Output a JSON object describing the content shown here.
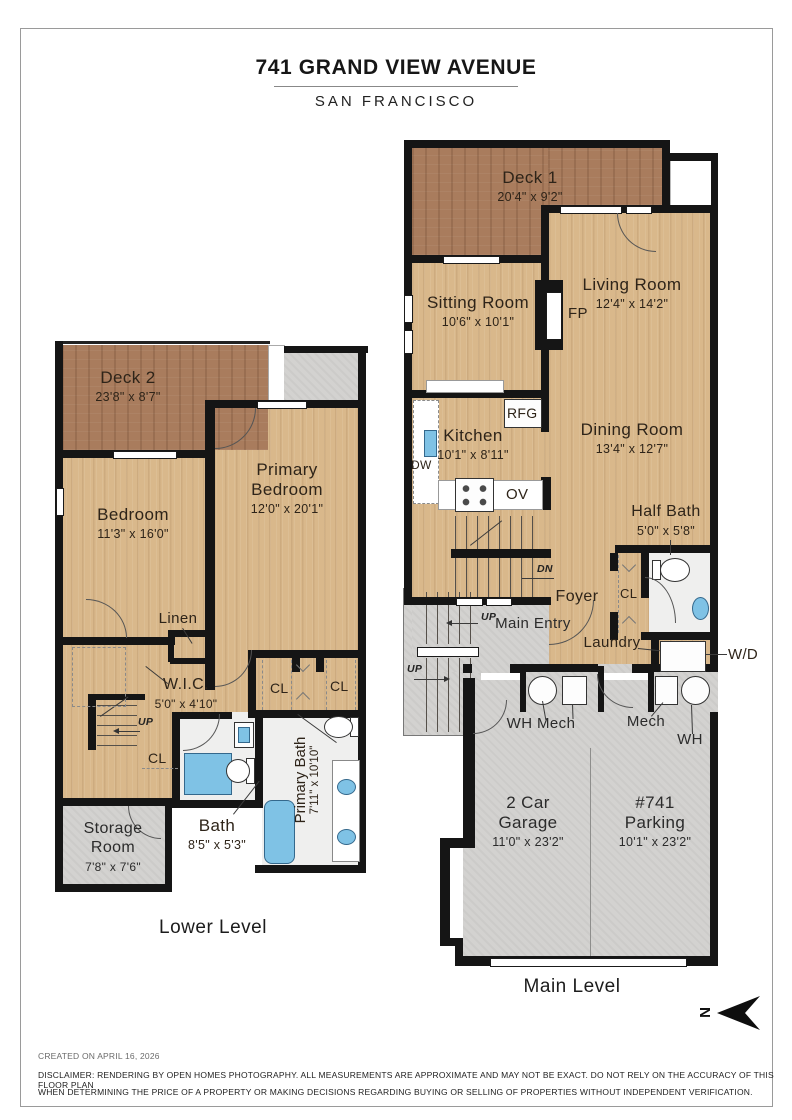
{
  "page": {
    "title": "741 GRAND VIEW AVENUE",
    "subtitle": "SAN FRANCISCO"
  },
  "main": {
    "label": "Main Level",
    "deck1": {
      "name": "Deck 1",
      "dims": "20'4\" x 9'2\""
    },
    "sitting": {
      "name": "Sitting Room",
      "dims": "10'6\" x 10'1\""
    },
    "living": {
      "name": "Living Room",
      "dims": "12'4\" x 14'2\""
    },
    "kitchen": {
      "name": "Kitchen",
      "dims": "10'1\" x 8'11\""
    },
    "dining": {
      "name": "Dining Room",
      "dims": "13'4\" x 12'7\""
    },
    "halfbath": {
      "name": "Half Bath",
      "dims": "5'0\" x 5'8\""
    },
    "garage": {
      "name": "2 Car Garage",
      "dims": "11'0\" x 23'2\""
    },
    "parking": {
      "name": "#741 Parking",
      "dims": "10'1\" x 23'2\""
    },
    "foyer": "Foyer",
    "entry": "Main Entry",
    "laundry": "Laundry",
    "fp": "FP",
    "rfg": "RFG",
    "dw": "DW",
    "ov": "OV",
    "wd": "W/D",
    "cl": "CL",
    "wh_mech_left": "WH Mech",
    "mech_right": "Mech",
    "wh_right": "WH",
    "dn": "DN",
    "up": "UP"
  },
  "lower": {
    "label": "Lower Level",
    "deck2": {
      "name": "Deck 2",
      "dims": "23'8\" x 8'7\""
    },
    "bedroom": {
      "name": "Bedroom",
      "dims": "11'3\" x 16'0\""
    },
    "primary": {
      "name": "Primary Bedroom",
      "dims": "12'0\" x 20'1\""
    },
    "wic": {
      "name": "W.I.C.",
      "dims": "5'0\" x 4'10\""
    },
    "bath": {
      "name": "Bath",
      "dims": "8'5\" x 5'3\""
    },
    "pbath": {
      "name": "Primary Bath",
      "dims": "7'11\" x 10'10\""
    },
    "storage": {
      "name": "Storage Room",
      "dims": "7'8\" x 7'6\""
    },
    "linen": "Linen",
    "cl": "CL",
    "up": "UP"
  },
  "compass": {
    "letter": "N"
  },
  "footer": {
    "created": "CREATED ON APRIL 16, 2026",
    "disclaimer1": "DISCLAIMER: RENDERING BY OPEN HOMES PHOTOGRAPHY. ALL MEASUREMENTS ARE APPROXIMATE AND MAY NOT BE EXACT. DO NOT RELY ON THE ACCURACY OF THIS FLOOR PLAN",
    "disclaimer2": "WHEN DETERMINING THE PRICE OF A PROPERTY OR MAKING DECISIONS REGARDING BUYING OR SELLING OF PROPERTIES WITHOUT INDEPENDENT VERIFICATION."
  }
}
